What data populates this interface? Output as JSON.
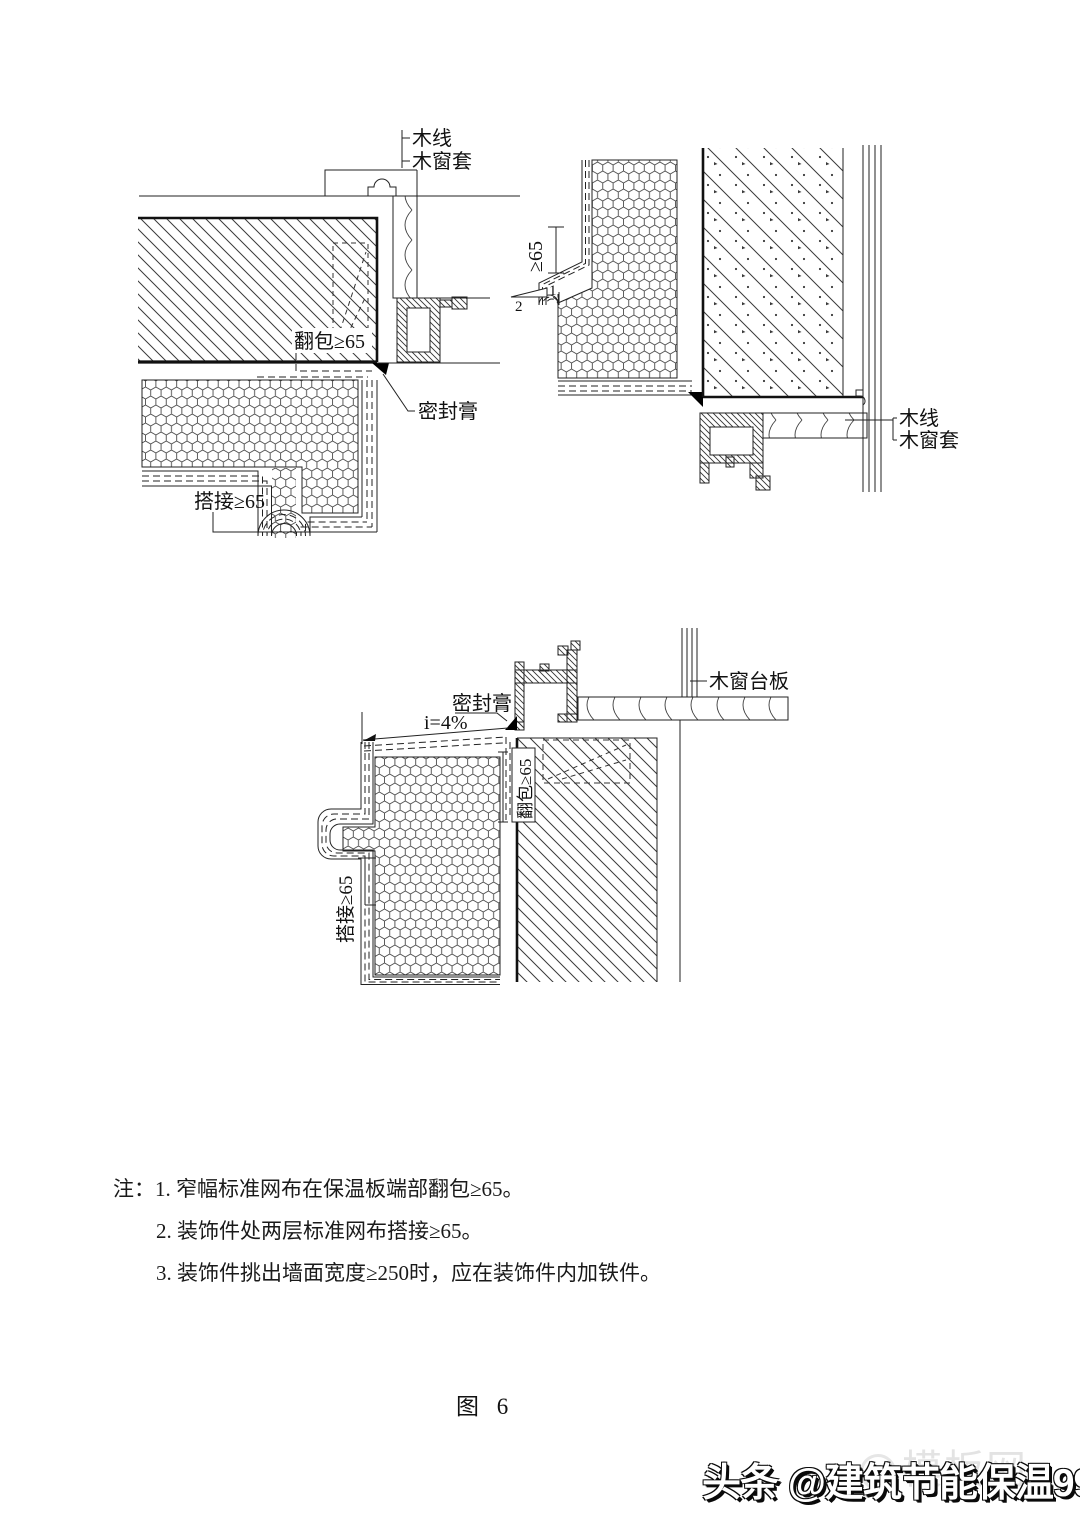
{
  "drawing1": {
    "wood_line": "木线",
    "wood_casing": "木窗套",
    "wrap": "翻包≥65",
    "sealant": "密封膏",
    "overlap": "搭接≥65"
  },
  "drawing2": {
    "dim65": "≥65",
    "slope_rise": "1",
    "slope_run": "2",
    "wood_line": "木线",
    "wood_casing": "木窗套"
  },
  "drawing3": {
    "sealant": "密封膏",
    "slope": "i=4%",
    "sill_board": "木窗台板",
    "wrap": "翻包≥65",
    "overlap": "搭接≥65"
  },
  "notes": {
    "prefix": "注：",
    "items": [
      "1. 窄幅标准网布在保温板端部翻包≥65。",
      "2. 装饰件处两层标准网布搭接≥65。",
      "3. 装饰件挑出墙面宽度≥250时，应在装饰件内加铁件。"
    ]
  },
  "caption": "图 6",
  "watermark": {
    "main": "头条 @建筑节能保温99",
    "faint": "模板网"
  }
}
